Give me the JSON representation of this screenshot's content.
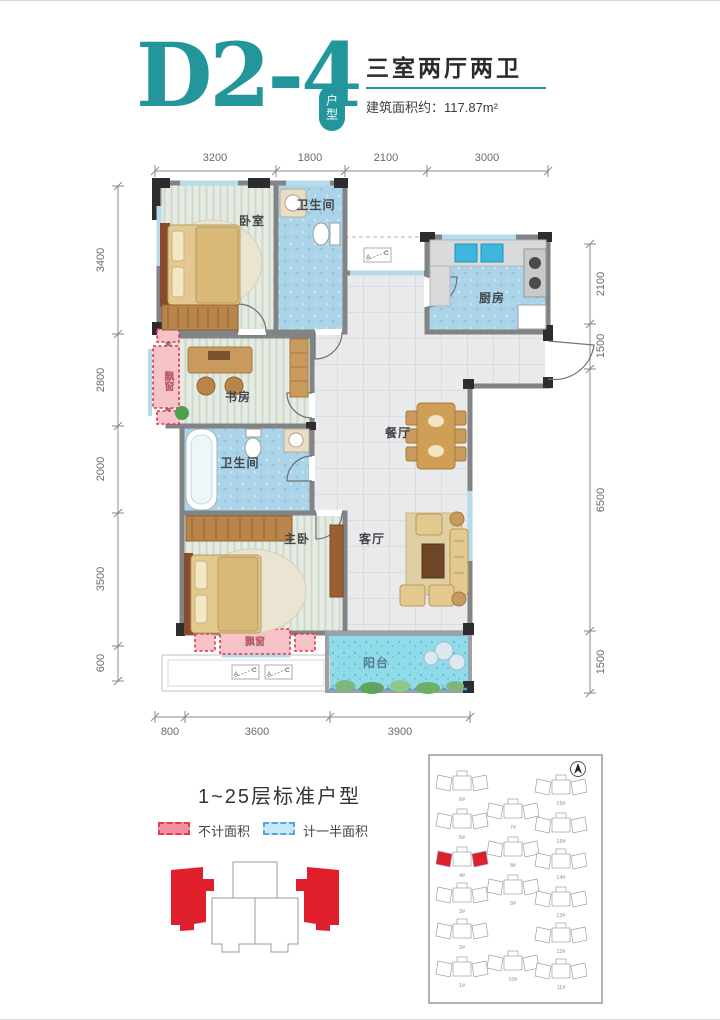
{
  "header": {
    "unit_code": "D2-4",
    "unit_badge": "户型",
    "layout_title": "三室两厅两卫",
    "area_text": "建筑面积约：117.87m²"
  },
  "plan": {
    "dims": {
      "top": [
        "3200",
        "1800",
        "2100",
        "3000"
      ],
      "left": [
        "3400",
        "2800",
        "2000",
        "3500",
        "600"
      ],
      "right": [
        "2100",
        "1500",
        "6500",
        "1500"
      ],
      "bottom": [
        "800",
        "3600",
        "3900"
      ]
    },
    "rooms": {
      "bedroom": "卧室",
      "bath_top": "卫生间",
      "kitchen": "厨房",
      "study": "书房",
      "dining": "餐厅",
      "bath_mid": "卫生间",
      "master": "主卧",
      "living": "客厅",
      "balcony": "阳台",
      "bay_left": "飘窗",
      "bay_bottom": "飘窗"
    },
    "section_marker": {
      "a": "A",
      "c": "C"
    }
  },
  "footer": {
    "floors_note": "1~25层标准户型",
    "legend": [
      {
        "label": "不计面积",
        "fill": "#f590a0",
        "border": "#e23c52"
      },
      {
        "label": "计一半面积",
        "fill": "#c8e7f8",
        "border": "#52a8dc"
      }
    ]
  },
  "siteplan": {
    "buildings": [
      {
        "label": "6#",
        "x": 34,
        "y": 30,
        "highlight": false
      },
      {
        "label": "16#",
        "x": 133,
        "y": 34,
        "highlight": false
      },
      {
        "label": "5#",
        "x": 34,
        "y": 68,
        "highlight": false
      },
      {
        "label": "7#",
        "x": 85,
        "y": 58,
        "highlight": false
      },
      {
        "label": "15#",
        "x": 133,
        "y": 72,
        "highlight": false
      },
      {
        "label": "4#",
        "x": 34,
        "y": 106,
        "highlight": true
      },
      {
        "label": "8#",
        "x": 85,
        "y": 96,
        "highlight": false
      },
      {
        "label": "14#",
        "x": 133,
        "y": 108,
        "highlight": false
      },
      {
        "label": "3#",
        "x": 34,
        "y": 142,
        "highlight": false
      },
      {
        "label": "9#",
        "x": 85,
        "y": 134,
        "highlight": false
      },
      {
        "label": "13#",
        "x": 133,
        "y": 146,
        "highlight": false
      },
      {
        "label": "2#",
        "x": 34,
        "y": 178,
        "highlight": false
      },
      {
        "label": "12#",
        "x": 133,
        "y": 182,
        "highlight": false
      },
      {
        "label": "1#",
        "x": 34,
        "y": 216,
        "highlight": false
      },
      {
        "label": "10#",
        "x": 85,
        "y": 210,
        "highlight": false
      },
      {
        "label": "11#",
        "x": 133,
        "y": 218,
        "highlight": false
      }
    ]
  },
  "colors": {
    "accent_teal": "#23969c",
    "highlight_red": "#e01f2d",
    "bay_pink": "#f6c3c8",
    "bay_border": "#e5304a",
    "balcony_cyan": "#8fdbe9",
    "floor_green": "#e5ebe2",
    "wet_blue": "#abd4e8",
    "tile_gray": "#e9eaec",
    "wall_dark": "#2d2d2f"
  }
}
